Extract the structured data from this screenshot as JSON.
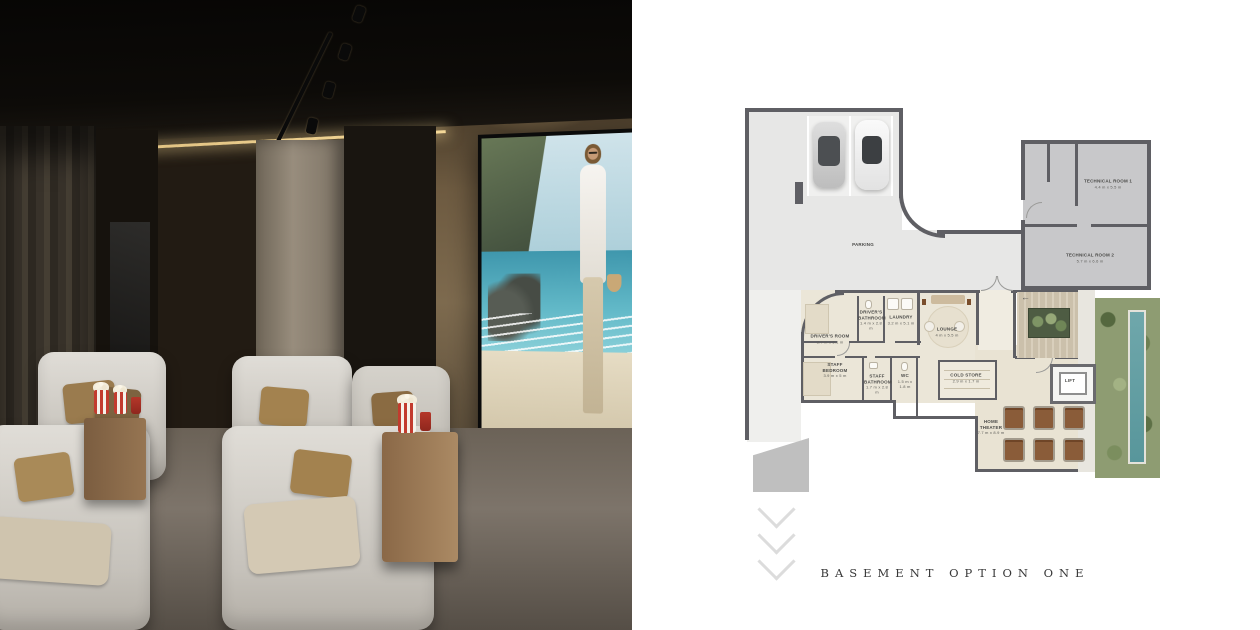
{
  "colors": {
    "wall": "#5f5f64",
    "garage_floor": "#e7e7e6",
    "technical_floor": "#c8c8ca",
    "interior_floor": "#ebe6d8",
    "garden": "#8e9c72",
    "pool": "#6fa7ab",
    "popcorn_red": "#c23b2e",
    "cove_light": "#f0cf8f"
  },
  "plan": {
    "caption": "BASEMENT OPTION ONE",
    "icons": {
      "stair_arrow": "←"
    },
    "rooms": {
      "parking": {
        "name": "PARKING"
      },
      "technical_room_1": {
        "name": "TECHNICAL ROOM 1",
        "dims": "4.4 m x 5.5 m"
      },
      "technical_room_2": {
        "name": "TECHNICAL ROOM 2",
        "dims": "5.7 m x 6.6 m"
      },
      "drivers_room": {
        "name": "DRIVER'S ROOM",
        "dims": "3.7 m x 5.1 m"
      },
      "drivers_bathroom": {
        "name": "DRIVER'S BATHROOM",
        "dims": "1.4 m x 2.8 m"
      },
      "laundry": {
        "name": "LAUNDRY",
        "dims": "3.2 m x 5.1 m"
      },
      "lounge": {
        "name": "LOUNGE",
        "dims": "4 m x 5.5 m"
      },
      "staff_bedroom": {
        "name": "STAFF BEDROOM",
        "dims": "3.9 m x 5 m"
      },
      "staff_bathroom": {
        "name": "STAFF BATHROOM",
        "dims": "1.7 m x 2.8 m"
      },
      "wc": {
        "name": "WC",
        "dims": "1.5 m x 1.8 m"
      },
      "cold_store": {
        "name": "COLD STORE",
        "dims": "2.9 m x 1.7 m"
      },
      "home_theater": {
        "name": "HOME THEATER",
        "dims": "7.7 m x 8.9 m"
      },
      "lift": {
        "name": "LIFT"
      }
    }
  }
}
